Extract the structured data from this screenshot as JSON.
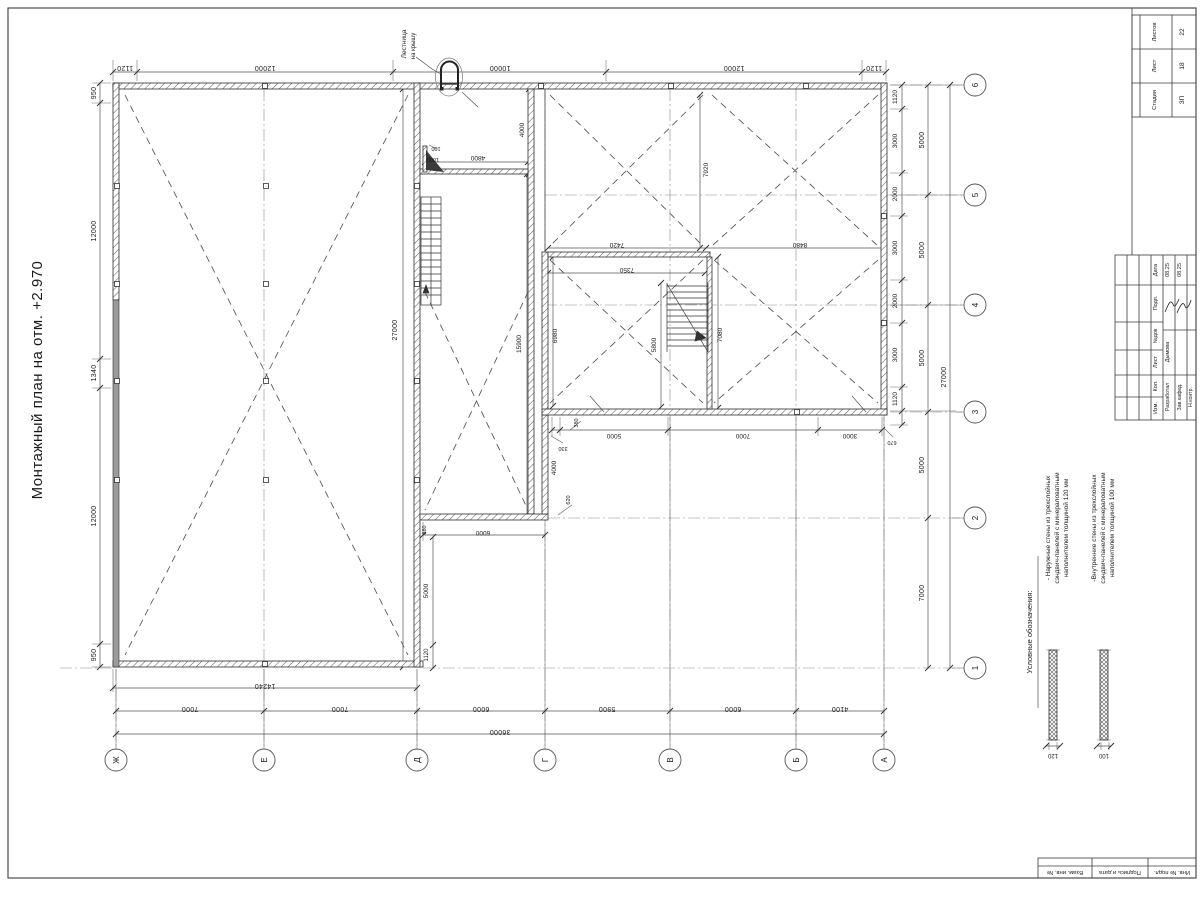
{
  "sheet": {
    "title": "Монтажный план на отм. +2.970"
  },
  "annotation": {
    "line1": "Лестница",
    "line2": "на крышу"
  },
  "axes": {
    "letters": [
      "Ж",
      "Е",
      "Д",
      "Г",
      "В",
      "Б",
      "А"
    ],
    "numbers": [
      "6",
      "5",
      "4",
      "3",
      "2",
      "1"
    ]
  },
  "dims": {
    "top": [
      "1120",
      "12000",
      "10000",
      "12000",
      "1120"
    ],
    "left": [
      "950",
      "12000",
      "1340",
      "12000",
      "950"
    ],
    "right_inner": [
      "1120",
      "3000",
      "2000",
      "3000",
      "2000",
      "3000",
      "1120"
    ],
    "right_outer": [
      "5000",
      "5000",
      "5000",
      "5000",
      "7000"
    ],
    "right_total": "27000",
    "bottom_span": "14240",
    "bottom": [
      "7000",
      "7000",
      "6000",
      "5900",
      "6000",
      "4100"
    ],
    "bottom_total": "36000",
    "rs_bottom": [
      "380",
      "5000",
      "7000",
      "3000",
      "670"
    ],
    "inner": {
      "hall": "27000",
      "v4000": "4000",
      "h4800": "4800",
      "s100": "100",
      "s1000": "1000",
      "v15900": "15900",
      "v6980": "6980",
      "v5800": "5800",
      "v7080": "7080",
      "v7920": "7920",
      "h7420": "7420",
      "h8480": "8480",
      "h7350": "7350",
      "s330": "330",
      "v4000b": "4000",
      "s620": "620",
      "s880": "880",
      "h6000": "6000",
      "v5000": "5000",
      "v1120": "1120"
    }
  },
  "legend": {
    "title": "Условные обозначения:",
    "item1": {
      "l1": "- Наружные стены из трехслойных",
      "l2": "сэндвич-панелей с минераловатным",
      "l3": "наполнителем толщиной 120 мм",
      "dim": "120"
    },
    "item2": {
      "l1": "-Внутренние стены из трехслойных",
      "l2": "сэндвич-панелей с минераловатным",
      "l3": "наполнителем толщиной 100 мм",
      "dim": "100"
    }
  },
  "stamp": {
    "stadiya_label": "Стадия",
    "list_label": "Лист",
    "listov_label": "Листов",
    "stadiya": "ЗП",
    "list": "18",
    "listov": "22",
    "col_labels": {
      "data": "Дата",
      "podp": "Подп.",
      "ndok": "№док",
      "list": "Лист",
      "kol": "Кол.",
      "izm": "Изм."
    },
    "rows": {
      "r1_role": "Разработал",
      "r1_name": "Дымова",
      "r1_date": "08.25",
      "r2_role": "Зав.кафед.",
      "r2_date": "08.25",
      "r3_role": "Н.контр."
    }
  },
  "frame_cells": {
    "c1": "Взам. инв. №",
    "c2": "Подпись и дата",
    "c3": "Инв. № подл."
  }
}
